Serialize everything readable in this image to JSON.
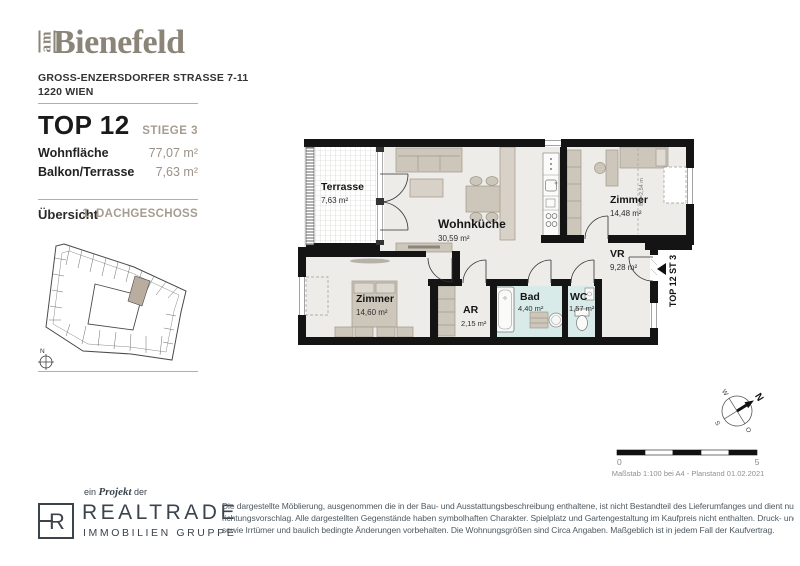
{
  "header": {
    "logo_prefix": "am",
    "logo_name": "Bienefeld",
    "address_line1": "GROSS-ENZERSDORFER STRASSE 7-11",
    "address_line2": "1220 WIEN"
  },
  "unit": {
    "title": "TOP 12",
    "staircase": "STIEGE 3",
    "facts": [
      {
        "label": "Wohnfläche",
        "value": "77,07 m²"
      },
      {
        "label": "Balkon/Terrasse",
        "value": "7,63 m²"
      }
    ]
  },
  "overview": {
    "label": "Übersicht",
    "floor": "1. DACHGESCHOSS",
    "compass_n": "N"
  },
  "floorplan": {
    "rooms": [
      {
        "name": "Terrasse",
        "area": "7,63 m²"
      },
      {
        "name": "Wohnküche",
        "area": "30,59 m²"
      },
      {
        "name": "Zimmer",
        "area": "14,48 m²"
      },
      {
        "name": "VR",
        "area": "9,28 m²"
      },
      {
        "name": "Zimmer",
        "area": "14,60 m²"
      },
      {
        "name": "AR",
        "area": "2,15 m²"
      },
      {
        "name": "Bad",
        "area": "4,40 m²"
      },
      {
        "name": "WC",
        "area": "1,57 m²"
      }
    ],
    "entrance_label": "TOP 12 ST 3",
    "height_note": "BH=2,54 m"
  },
  "compass": {
    "n": "N",
    "w": "W",
    "s": "S",
    "o": "O"
  },
  "scalebar": {
    "start": "0",
    "end": "5",
    "caption": "Maßstab 1:100 bei A4 - Planstand 01.02.2021"
  },
  "footer": {
    "project_prefix": "ein",
    "project_word": "Projekt",
    "project_suffix": "der",
    "logo_letter": "R",
    "logo_name": "REALTRADE",
    "logo_sub": "IMMOBILIEN GRUPPE",
    "disclaimer_lines": [
      "Die dargestellte Möblierung, ausgenommen die in der Bau- und Ausstattungsbeschreibung enthaltene, ist nicht Bestandteil des Lieferumfanges und dient nur als Ein-",
      "richtungsvorschlag. Alle dargestellten Gegenstände haben symbolhaften Charakter. Spielplatz und Gartengestaltung im Kaufpreis nicht enthalten. Druck- und Satzfehler,",
      "sowie Irrtümer und baulich bedingte Änderungen vorbehalten. Die Wohnungsgrößen sind Circa Angaben. Maßgeblich ist in jedem Fall der Kaufvertrag."
    ]
  },
  "colors": {
    "brand_taupe": "#8b8478",
    "accent_taupe": "#a59d8f",
    "wall_black": "#141414",
    "floor": "#edece8",
    "bath_cyan": "#d9ebe9",
    "furniture": "#cdc6bb",
    "footer_slate": "#3b434d",
    "disclaimer_gray": "#4d5a63"
  }
}
